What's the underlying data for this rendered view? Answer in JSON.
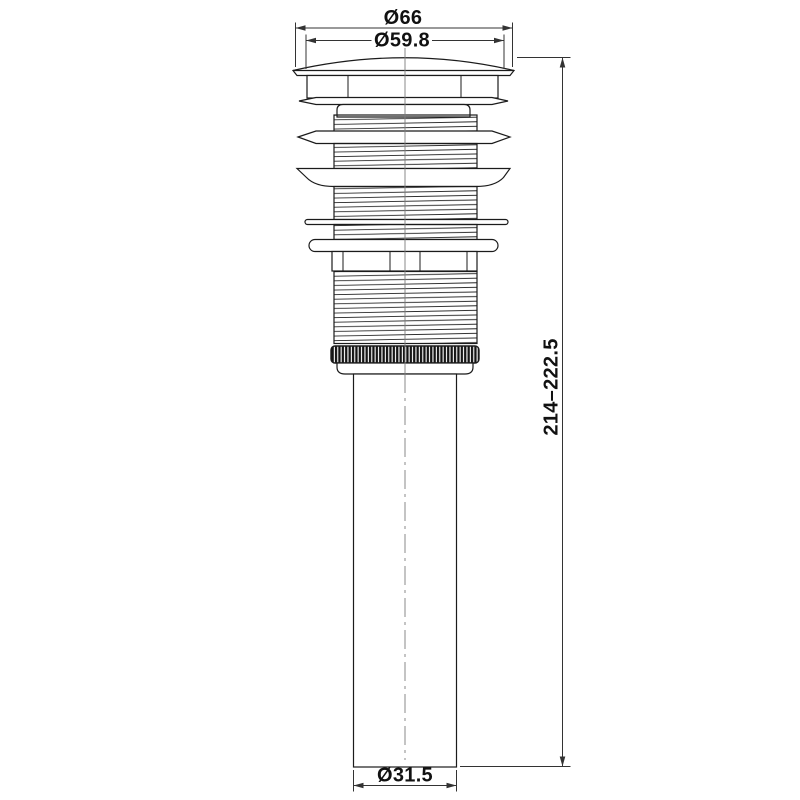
{
  "diagram": {
    "type": "technical-drawing",
    "background_color": "#ffffff",
    "outline_color": "#1b1b1b",
    "dimension_color": "#333333",
    "centerline_color": "#7d7d7d",
    "knurl_color": "#141414",
    "dimensions": {
      "outer_cap_diameter": "Ø66",
      "cap_dome_diameter": "Ø59.8",
      "overall_height_range": "214–222.5",
      "tube_diameter": "Ø31.5"
    }
  }
}
